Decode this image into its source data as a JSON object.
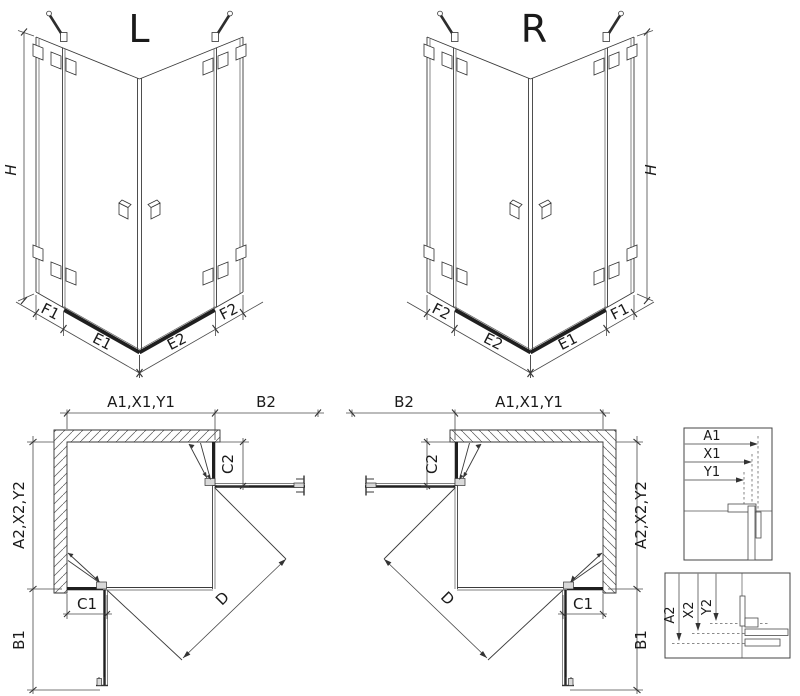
{
  "drawing": {
    "axo_left": {
      "title": "L",
      "dim_h": "H",
      "dim_f1": "F1",
      "dim_e1": "E1",
      "dim_e2": "E2",
      "dim_f2": "F2"
    },
    "axo_right": {
      "title": "R",
      "dim_h": "H",
      "dim_f2": "F2",
      "dim_e2": "E2",
      "dim_e1": "E1",
      "dim_f1": "F1"
    },
    "plan_left": {
      "dim_a1": "A1,X1,Y1",
      "dim_b2": "B2",
      "dim_c2": "C2",
      "dim_a2": "A2,X2,Y2",
      "dim_b1": "B1",
      "dim_c1": "C1",
      "dim_d": "D"
    },
    "plan_right": {
      "dim_b2": "B2",
      "dim_a1": "A1,X1,Y1",
      "dim_c2": "C2",
      "dim_a2": "A2,X2,Y2",
      "dim_b1": "B1",
      "dim_c1": "C1",
      "dim_d": "D"
    },
    "detail_widths": {
      "dim_a1": "A1",
      "dim_x1": "X1",
      "dim_y1": "Y1"
    },
    "detail_depths": {
      "dim_a2": "A2",
      "dim_x2": "X2",
      "dim_y2": "Y2"
    }
  },
  "colors": {
    "line": "#3a3a3a",
    "thick_profile": "#1f1f1f",
    "background": "#ffffff"
  }
}
